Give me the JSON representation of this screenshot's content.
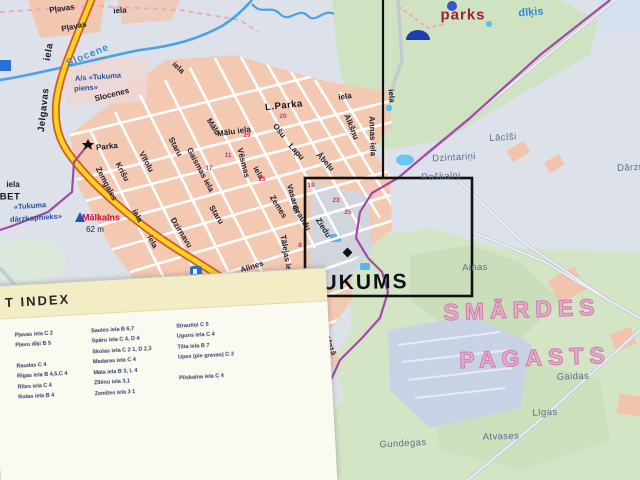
{
  "map": {
    "town_name": "JAUNTUKUMS",
    "region_name": "SMĀRDES PAGASTS",
    "labels": [
      {
        "t": "Pļavas",
        "x": 62,
        "y": 9,
        "r": -8,
        "c": "st",
        "n": "street-label-plavas"
      },
      {
        "t": "iela",
        "x": 120,
        "y": 11,
        "r": -4,
        "c": "st",
        "n": "street-label-iela"
      },
      {
        "t": "Pļavas",
        "x": 74,
        "y": 27,
        "r": -12,
        "c": "st",
        "n": "street-label-plavas-2"
      },
      {
        "t": "iela",
        "x": 49,
        "y": 52,
        "r": -80,
        "c": "stb",
        "n": "road-label-iela"
      },
      {
        "t": "Jelgavas",
        "x": 44,
        "y": 110,
        "r": -84,
        "c": "stb",
        "n": "road-label-jelgavas"
      },
      {
        "t": "Slocene",
        "x": 88,
        "y": 56,
        "r": -22,
        "c": "river",
        "n": "river-label-slocene"
      },
      {
        "t": "A/s «Tukuma",
        "x": 98,
        "y": 77,
        "r": -4,
        "c": "blue",
        "n": "poi-label-tukuma-piens"
      },
      {
        "t": "piens»",
        "x": 86,
        "y": 88,
        "r": -4,
        "c": "blue",
        "n": "poi-label-tukuma-piens-2"
      },
      {
        "t": "Slocenes",
        "x": 112,
        "y": 95,
        "r": -14,
        "c": "st",
        "n": "street-label-slocenes"
      },
      {
        "t": "iela",
        "x": 178,
        "y": 68,
        "r": 42,
        "c": "st",
        "n": "street-label-iela"
      },
      {
        "t": "Parka",
        "x": 107,
        "y": 147,
        "r": -6,
        "c": "st",
        "n": "street-label-parka"
      },
      {
        "t": "L.Parka",
        "x": 284,
        "y": 106,
        "r": -6,
        "c": "stb",
        "n": "street-label-l-parka"
      },
      {
        "t": "Zemgales",
        "x": 106,
        "y": 184,
        "r": 62,
        "c": "st",
        "n": "street-label-zemgales"
      },
      {
        "t": "Krišu",
        "x": 122,
        "y": 172,
        "r": 62,
        "c": "st",
        "n": "street-label-krisu"
      },
      {
        "t": "Vītolu",
        "x": 146,
        "y": 162,
        "r": 62,
        "c": "st",
        "n": "street-label-vitolu"
      },
      {
        "t": "iela",
        "x": 137,
        "y": 216,
        "r": 62,
        "c": "st",
        "n": "street-label-iela"
      },
      {
        "t": "iela",
        "x": 152,
        "y": 242,
        "r": 62,
        "c": "st",
        "n": "street-label-iela"
      },
      {
        "t": "Staru",
        "x": 175,
        "y": 147,
        "r": 62,
        "c": "st",
        "n": "street-label-staru"
      },
      {
        "t": "Gaismas iela",
        "x": 200,
        "y": 170,
        "r": 62,
        "c": "st",
        "n": "street-label-gaismas"
      },
      {
        "t": "Dzirnavu",
        "x": 181,
        "y": 233,
        "r": 58,
        "c": "st",
        "n": "street-label-dzirnavu"
      },
      {
        "t": "Mālu",
        "x": 213,
        "y": 127,
        "r": 58,
        "c": "st",
        "n": "street-label-malu"
      },
      {
        "t": "Mālu iela",
        "x": 234,
        "y": 132,
        "r": -8,
        "c": "st",
        "n": "street-label-malu-iela"
      },
      {
        "t": "Vēsmas",
        "x": 243,
        "y": 163,
        "r": 76,
        "c": "st",
        "n": "street-label-vesmas"
      },
      {
        "t": "iela",
        "x": 258,
        "y": 173,
        "r": 60,
        "c": "st",
        "n": "street-label-iela"
      },
      {
        "t": "Ošu",
        "x": 279,
        "y": 131,
        "r": 52,
        "c": "st",
        "n": "street-label-osu"
      },
      {
        "t": "Lapu",
        "x": 296,
        "y": 152,
        "r": 47,
        "c": "st",
        "n": "street-label-lapu"
      },
      {
        "t": "Ābeļu",
        "x": 325,
        "y": 162,
        "r": 47,
        "c": "st",
        "n": "street-label-abelu"
      },
      {
        "t": "Alkšņu",
        "x": 351,
        "y": 127,
        "r": 68,
        "c": "st",
        "n": "street-label-alksnu"
      },
      {
        "t": "Annas iela",
        "x": 372,
        "y": 136,
        "r": 88,
        "c": "st",
        "n": "street-label-annas"
      },
      {
        "t": "iela",
        "x": 345,
        "y": 97,
        "r": -8,
        "c": "st",
        "n": "street-label-iela"
      },
      {
        "t": "iela",
        "x": 391,
        "y": 96,
        "r": 85,
        "c": "st",
        "n": "street-label-iela"
      },
      {
        "t": "Staru",
        "x": 216,
        "y": 215,
        "r": 58,
        "c": "st",
        "n": "street-label-staru-2"
      },
      {
        "t": "Zemes",
        "x": 278,
        "y": 207,
        "r": 58,
        "c": "st",
        "n": "street-label-zemes"
      },
      {
        "t": "Graudu",
        "x": 301,
        "y": 218,
        "r": 58,
        "c": "st",
        "n": "street-label-graudu"
      },
      {
        "t": "Ziedu",
        "x": 323,
        "y": 228,
        "r": 58,
        "c": "st",
        "n": "street-label-ziedu"
      },
      {
        "t": "Vasaras",
        "x": 293,
        "y": 199,
        "r": 74,
        "c": "st",
        "n": "street-label-vasaras"
      },
      {
        "t": "Tālejas iela",
        "x": 286,
        "y": 256,
        "r": 80,
        "c": "st",
        "n": "street-label-talejas"
      },
      {
        "t": "Alīnes",
        "x": 252,
        "y": 267,
        "r": -18,
        "c": "st",
        "n": "street-label-alines"
      },
      {
        "t": "Parādes",
        "x": 252,
        "y": 319,
        "r": 48,
        "c": "st",
        "n": "street-label-parades"
      },
      {
        "t": "Alejas",
        "x": 282,
        "y": 326,
        "r": 48,
        "c": "st",
        "n": "street-label-alejas"
      },
      {
        "t": "Aviācijas",
        "x": 311,
        "y": 338,
        "r": 42,
        "c": "st",
        "n": "street-label-aviacijas"
      },
      {
        "t": "Mazā",
        "x": 330,
        "y": 346,
        "r": 68,
        "c": "st",
        "n": "street-label-maza"
      },
      {
        "t": "iela",
        "x": 292,
        "y": 361,
        "r": 45,
        "c": "st",
        "n": "street-label-iela"
      },
      {
        "t": "Jelgavas",
        "x": 257,
        "y": 338,
        "r": 70,
        "c": "stb",
        "n": "road-label-jelgavas-2"
      },
      {
        "t": "iela",
        "x": 273,
        "y": 390,
        "r": 74,
        "c": "stb",
        "n": "road-label-iela-2"
      },
      {
        "t": "JAUNTUKUMS",
        "x": 325,
        "y": 283,
        "r": -1,
        "c": "big",
        "n": "town-name-jauntukums"
      },
      {
        "t": "SMĀRDES",
        "x": 522,
        "y": 310,
        "r": -2,
        "c": "outline",
        "n": "region-name-smardes"
      },
      {
        "t": "PAGASTS",
        "x": 535,
        "y": 358,
        "r": -2,
        "c": "outline",
        "n": "region-name-pagasts"
      },
      {
        "t": "parks",
        "x": 463,
        "y": 15,
        "r": 0,
        "c": "parks",
        "n": "park-label"
      },
      {
        "t": "dīķis",
        "x": 531,
        "y": 13,
        "r": -4,
        "c": "dikis",
        "n": "pond-label"
      },
      {
        "t": "Mālkalns",
        "x": 101,
        "y": 218,
        "r": 0,
        "c": "peak",
        "n": "peak-label-malkalns"
      },
      {
        "t": "62 m",
        "x": 95,
        "y": 230,
        "r": 0,
        "c": "elev",
        "n": "peak-elevation"
      },
      {
        "t": "«Tukuma",
        "x": 30,
        "y": 206,
        "r": -4,
        "c": "blue",
        "n": "coop-label-tukuma"
      },
      {
        "t": "dārzkopnieks»",
        "x": 36,
        "y": 218,
        "r": -4,
        "c": "blue",
        "n": "coop-label-darzkopnieks"
      },
      {
        "t": "iela",
        "x": 13,
        "y": 185,
        "r": 0,
        "c": "st",
        "n": "edge-fragment-iela"
      },
      {
        "t": "BET",
        "x": 10,
        "y": 197,
        "r": 0,
        "c": "stb",
        "n": "edge-fragment-bet"
      },
      {
        "t": "Bēgoņi",
        "x": 131,
        "y": 293,
        "r": -2,
        "c": "gray",
        "n": "settlement-label-begoni"
      },
      {
        "t": "«17. poļu",
        "x": 189,
        "y": 333,
        "r": -4,
        "c": "st",
        "n": "area-label-17-polu"
      },
      {
        "t": "rajons»",
        "x": 193,
        "y": 346,
        "r": -4,
        "c": "st",
        "n": "area-label-rajons"
      },
      {
        "t": "Skaldroņi",
        "x": 33,
        "y": 360,
        "r": -2,
        "c": "gray",
        "n": "settlement-label-skaldroni"
      },
      {
        "t": "Saulgrieži",
        "x": 24,
        "y": 382,
        "r": -2,
        "c": "gray",
        "n": "settlement-label-saulgriezi"
      },
      {
        "t": "Dzintariņi",
        "x": 454,
        "y": 158,
        "r": -3,
        "c": "gray",
        "n": "settlement-label-dzintarini"
      },
      {
        "t": "Raškalni",
        "x": 441,
        "y": 177,
        "r": -3,
        "c": "gray",
        "n": "settlement-label-raskalni"
      },
      {
        "t": "Lācīši",
        "x": 503,
        "y": 138,
        "r": -3,
        "c": "gray",
        "n": "settlement-label-lacisi"
      },
      {
        "t": "Dārzni",
        "x": 632,
        "y": 168,
        "r": -3,
        "c": "gray",
        "n": "settlement-label-darzni"
      },
      {
        "t": "Ainas",
        "x": 475,
        "y": 268,
        "r": -2,
        "c": "gray",
        "n": "settlement-label-ainas"
      },
      {
        "t": "Gaidas",
        "x": 573,
        "y": 377,
        "r": -2,
        "c": "gray",
        "n": "settlement-label-gaidas"
      },
      {
        "t": "Līgas",
        "x": 545,
        "y": 413,
        "r": -2,
        "c": "gray",
        "n": "settlement-label-ligas"
      },
      {
        "t": "Atvases",
        "x": 501,
        "y": 437,
        "r": -2,
        "c": "gray",
        "n": "settlement-label-atvases"
      },
      {
        "t": "Gundegas",
        "x": 403,
        "y": 444,
        "r": -3,
        "c": "gray",
        "n": "settlement-label-gundegas"
      },
      {
        "t": "20",
        "x": 283,
        "y": 117,
        "r": 0,
        "c": "num",
        "n": "house-number"
      },
      {
        "t": "29",
        "x": 247,
        "y": 136,
        "r": 0,
        "c": "num",
        "n": "house-number"
      },
      {
        "t": "11",
        "x": 228,
        "y": 156,
        "r": 0,
        "c": "num",
        "n": "house-number"
      },
      {
        "t": "17",
        "x": 209,
        "y": 169,
        "r": 0,
        "c": "num",
        "n": "house-number"
      },
      {
        "t": "15",
        "x": 262,
        "y": 180,
        "r": 0,
        "c": "num",
        "n": "house-number"
      },
      {
        "t": "19",
        "x": 311,
        "y": 186,
        "r": 0,
        "c": "num",
        "n": "house-number"
      },
      {
        "t": "23",
        "x": 336,
        "y": 201,
        "r": 0,
        "c": "num",
        "n": "house-number"
      },
      {
        "t": "25",
        "x": 348,
        "y": 213,
        "r": 0,
        "c": "num",
        "n": "house-number"
      },
      {
        "t": "8",
        "x": 300,
        "y": 246,
        "r": 0,
        "c": "num",
        "n": "house-number"
      }
    ]
  },
  "index_panel": {
    "title": "T INDEX",
    "columns": [
      [
        "Pļavas iela C 2",
        "Pļavu dīķi B 5",
        "",
        "Raudas C 4",
        "Rīgas iela B 4,5,C 4",
        "Rītes iela C 4",
        "Rotas iela B 4"
      ],
      [
        "Saules iela B 6,7",
        "Spāru iela C 4, D 4",
        "Skolas iela C 2 1, D 2,3",
        "Madaras iela C 4",
        "Māla iela B 3, L 4",
        "Zīlēnu iela 3,1",
        "Zemītes iela 3 1"
      ],
      [
        "Strautiņi C 5",
        "Uguns iela C 4",
        "Tilta iela B 7",
        "Upes (pie gravas) C 3",
        "",
        "Pilskalna iela C 4"
      ]
    ]
  },
  "colors": {
    "background": "#dde1e9",
    "urban_fill": "#f4c9b2",
    "park_green": "#cfe3c3",
    "road_yellow": "#f4d321",
    "road_casing": "#d9542b",
    "boundary_purple": "#a14aa8",
    "water_blue": "#49a3e6",
    "selection_box": "#111111",
    "region_label_pink": "#cf7fae"
  }
}
